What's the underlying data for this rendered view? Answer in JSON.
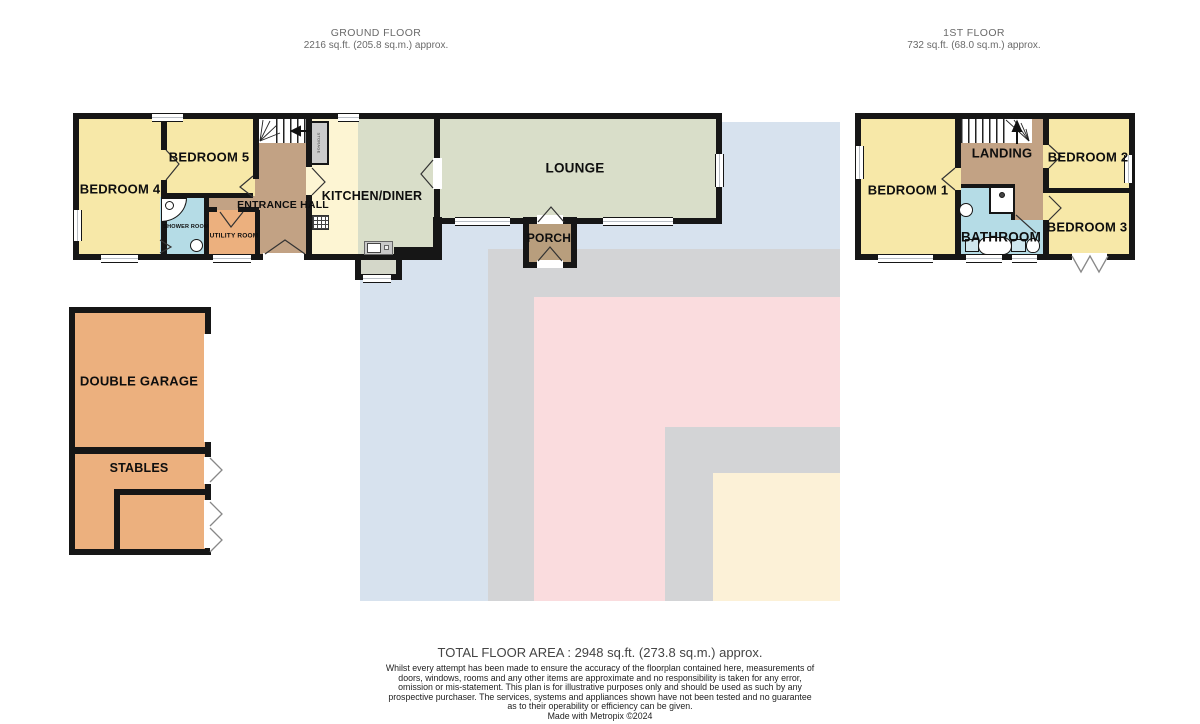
{
  "header": {
    "ground_floor": {
      "title": "GROUND FLOOR",
      "area": "2216 sq.ft. (205.8 sq.m.) approx."
    },
    "first_floor": {
      "title": "1ST FLOOR",
      "area": "732 sq.ft. (68.0 sq.m.) approx."
    }
  },
  "rooms": {
    "ground": {
      "bedroom4": "BEDROOM 4",
      "bedroom5": "BEDROOM 5",
      "shower_room": "SHOWER ROOM",
      "utility_room": "UTILITY ROOM",
      "entrance_hall": "ENTRANCE HALL",
      "storage": "STORAGE",
      "kitchen_diner": "KITCHEN/DINER",
      "lounge": "LOUNGE",
      "porch": "PORCH"
    },
    "outbuilding": {
      "double_garage": "DOUBLE GARAGE",
      "stables": "STABLES"
    },
    "first": {
      "bedroom1": "BEDROOM 1",
      "landing": "LANDING",
      "bedroom2": "BEDROOM 2",
      "bathroom": "BATHROOM",
      "bedroom3": "BEDROOM 3"
    }
  },
  "footer": {
    "total_area": "TOTAL FLOOR AREA : 2948 sq.ft. (273.8 sq.m.) approx.",
    "disclaimer": "Whilst every attempt has been made to ensure the accuracy of the floorplan contained here, measurements of doors, windows, rooms and any other items are approximate and no responsibility is taken for any error, omission or mis-statement. This plan is for illustrative purposes only and should be used as such by any prospective purchaser. The services, systems and appliances shown have not been tested and no guarantee as to their operability or efficiency can be given.",
    "credit": "Made with Metropix ©2024"
  },
  "colors": {
    "wall": "#161616",
    "bedroom_yellow": "#f7e8a8",
    "lounge_sage": "#d9dec9",
    "kitchen_cream": "#fdf5d3",
    "hall_tan": "#c2a284",
    "porch_tan": "#b89e7d",
    "garage_orange": "#ecb07e",
    "bath_blue": "#b5dce6",
    "bg_blue": "#d7e2ee",
    "bg_gray": "#d3d4d6",
    "bg_pink": "#fadcde",
    "bg_cream": "#fcf1d7"
  }
}
